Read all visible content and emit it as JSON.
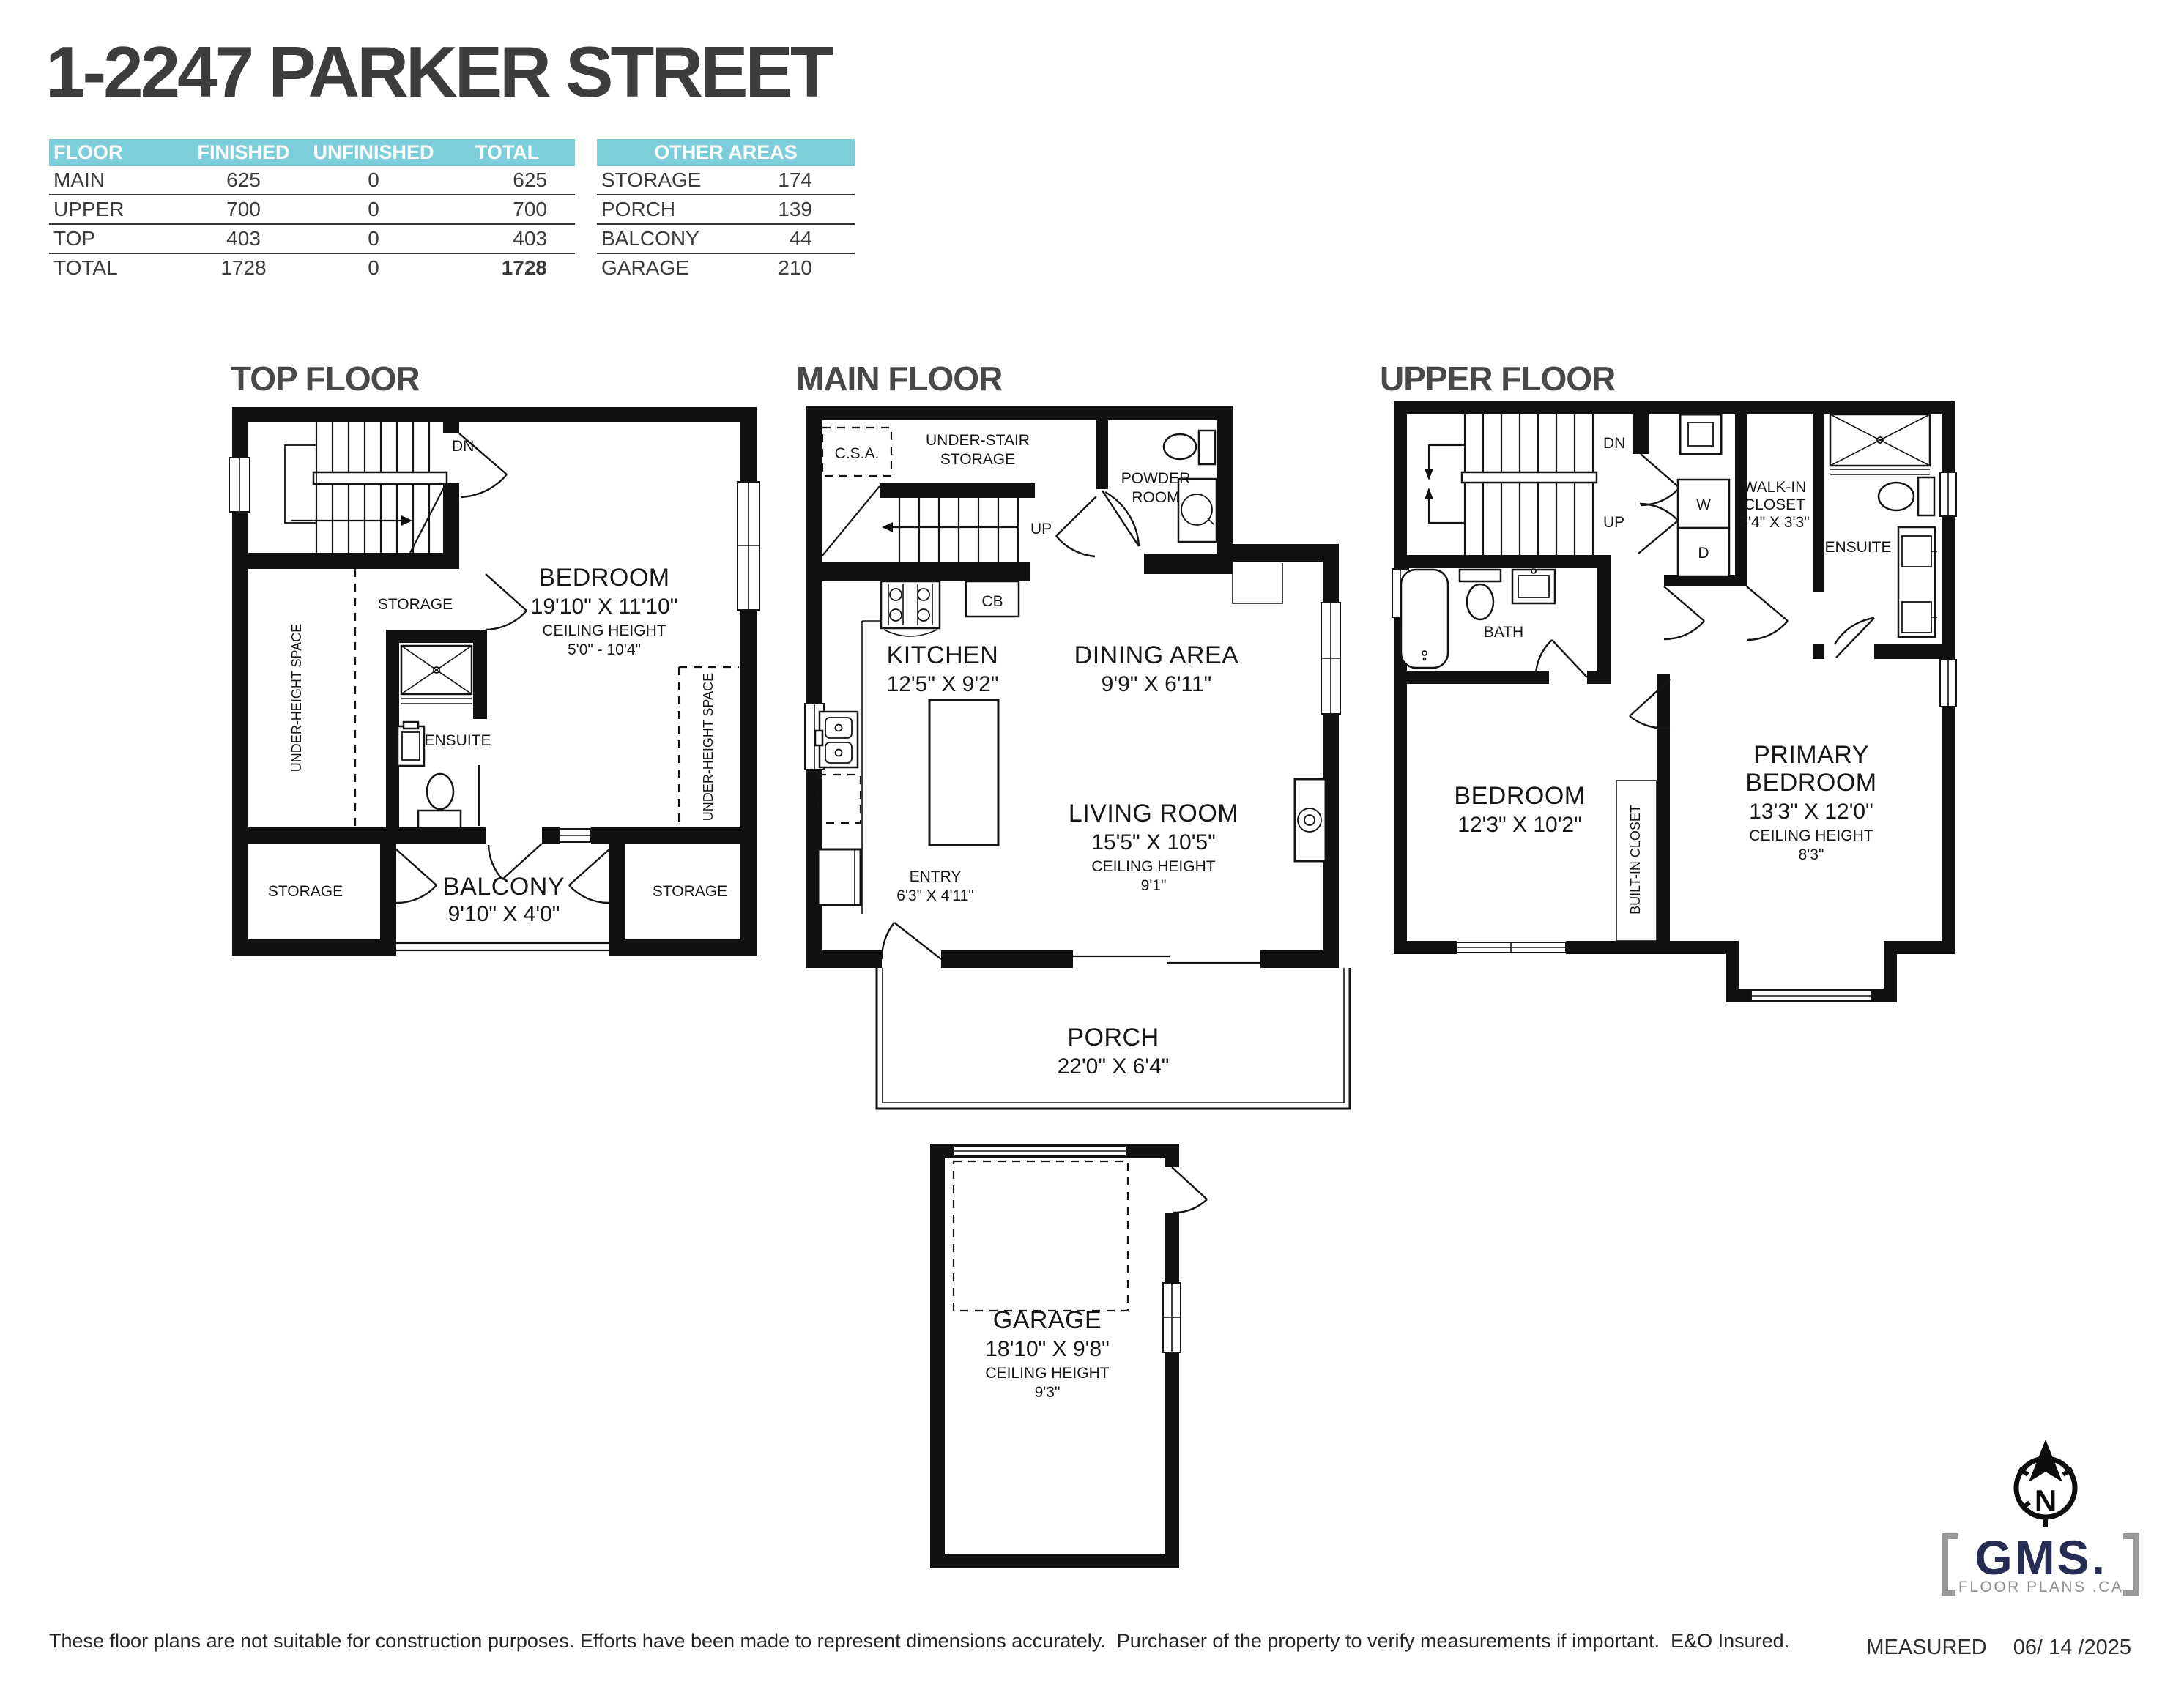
{
  "title": "1-2247 PARKER STREET",
  "colors": {
    "teal": "#7dcedb",
    "wall": "#101010",
    "navy": "#272c52",
    "gray": "#8f8f8f"
  },
  "area_table": {
    "headers": [
      "FLOOR",
      "FINISHED",
      "UNFINISHED",
      "TOTAL"
    ],
    "rows": [
      [
        "MAIN",
        "625",
        "0",
        "625"
      ],
      [
        "UPPER",
        "700",
        "0",
        "700"
      ],
      [
        "TOP",
        "403",
        "0",
        "403"
      ],
      [
        "TOTAL",
        "1728",
        "0",
        "1728"
      ]
    ]
  },
  "other_areas": {
    "header": "OTHER AREAS",
    "rows": [
      [
        "STORAGE",
        "174"
      ],
      [
        "PORCH",
        "139"
      ],
      [
        "BALCONY",
        "44"
      ],
      [
        "GARAGE",
        "210"
      ]
    ]
  },
  "top_floor": {
    "heading": "TOP FLOOR",
    "dn": "DN",
    "storage_mid": "STORAGE",
    "under_height_left": "UNDER-HEIGHT SPACE",
    "under_height_right": "UNDER-HEIGHT SPACE",
    "ensuite": "ENSUITE",
    "bedroom_name": "BEDROOM",
    "bedroom_dims": "19'10\" X 11'10\"",
    "ceiling_label": "CEILING HEIGHT",
    "ceiling_value": "5'0\" - 10'4\"",
    "storage_bl": "STORAGE",
    "storage_br": "STORAGE",
    "balcony_name": "BALCONY",
    "balcony_dims": "9'10\" X 4'0\""
  },
  "main_floor": {
    "heading": "MAIN FLOOR",
    "csa": "C.S.A.",
    "under_stair_1": "UNDER-STAIR",
    "under_stair_2": "STORAGE",
    "up": "UP",
    "powder_1": "POWDER",
    "powder_2": "ROOM",
    "cb": "CB",
    "kitchen_name": "KITCHEN",
    "kitchen_dims": "12'5\" X 9'2\"",
    "dining_name": "DINING AREA",
    "dining_dims": "9'9\" X 6'11\"",
    "living_name": "LIVING ROOM",
    "living_dims": "15'5\" X 10'5\"",
    "ceiling_label": "CEILING HEIGHT",
    "ceiling_value": "9'1\"",
    "entry_name": "ENTRY",
    "entry_dims": "6'3\" X 4'11\"",
    "porch_name": "PORCH",
    "porch_dims": "22'0\" X 6'4\""
  },
  "garage": {
    "name": "GARAGE",
    "dims": "18'10\" X 9'8\"",
    "ceiling_label": "CEILING HEIGHT",
    "ceiling_value": "9'3\""
  },
  "upper_floor": {
    "heading": "UPPER FLOOR",
    "dn": "DN",
    "up": "UP",
    "washer": "W",
    "dryer": "D",
    "walkin_1": "WALK-IN",
    "walkin_2": "CLOSET",
    "walkin_dims": "8'4\" X 3'3\"",
    "ensuite": "ENSUITE",
    "bath": "BATH",
    "bedroom_name": "BEDROOM",
    "bedroom_dims": "12'3\" X 10'2\"",
    "builtin_closet": "BUILT-IN CLOSET",
    "primary_1": "PRIMARY",
    "primary_2": "BEDROOM",
    "primary_dims": "13'3\" X 12'0\"",
    "ceiling_label": "CEILING HEIGHT",
    "ceiling_value": "8'3\""
  },
  "footer": {
    "disclaimer": "These floor plans are not suitable for construction purposes. Efforts have been made to represent dimensions accurately.  Purchaser of the property to verify measurements if important.  E&O Insured.",
    "measured_label": "MEASURED",
    "measured_date": "06/ 14 /2025"
  },
  "logo": {
    "compass_n": "N",
    "name": "GMS.",
    "tagline": "FLOOR PLANS .CA"
  }
}
